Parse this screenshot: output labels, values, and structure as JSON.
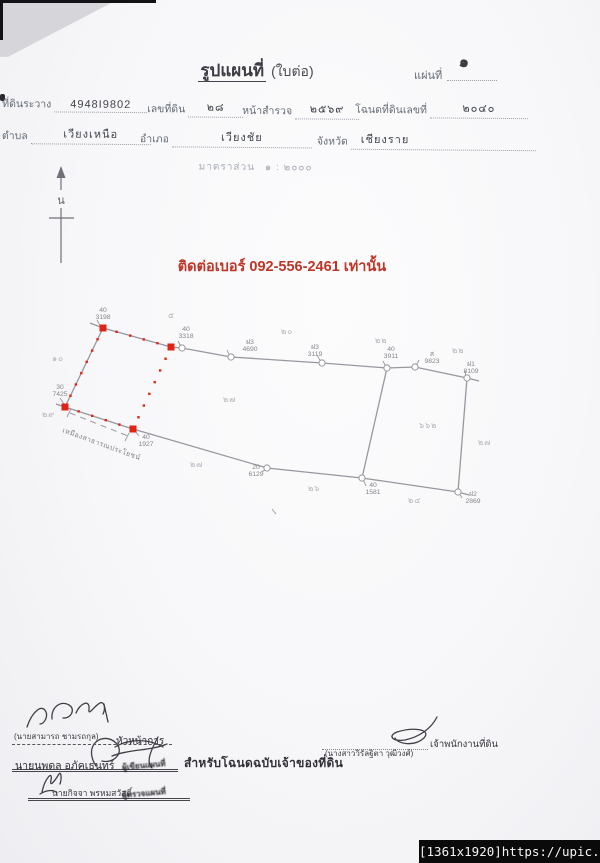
{
  "meta": {
    "watermark": "[1361x1920]https://upic.me/"
  },
  "header": {
    "title": "รูปแผนที่",
    "title_suffix": "(ใบต่อ)",
    "sheet_label": "แผ่นที่",
    "sheet_value": "๑"
  },
  "form": {
    "fields_row1": [
      {
        "label": "ที่ดินระวาง",
        "value": "4948I9802"
      },
      {
        "label": "เลขที่ดิน",
        "value": "๒๘"
      },
      {
        "label": "หน้าสำรวจ",
        "value": "๒๕๖๙"
      },
      {
        "label": "โฉนดที่ดินเลขที่",
        "value": "๒๐๔๐"
      }
    ],
    "fields_row2": [
      {
        "label": "ตำบล",
        "value": "เวียงเหนือ"
      },
      {
        "label": "อำเภอ",
        "value": "เวียงชัย"
      },
      {
        "label": "จังหวัด",
        "value": "เชียงราย"
      }
    ],
    "scale_label": "มาตราส่วน",
    "scale_value": "๑ : ๒๐๐๐"
  },
  "north_label": "น",
  "notice": {
    "text": "ติดต่อเบอร์ 092-556-2461 เท่านั้น",
    "color": "#bf3527"
  },
  "map": {
    "line_color": "#97979f",
    "red_color": "#df2417",
    "label_color": "#84848c",
    "adjacent_color": "#b2b2ba",
    "boundaries": [
      [
        [
          90,
          323
        ],
        [
          103,
          328
        ],
        [
          171,
          347
        ],
        [
          182,
          348
        ],
        [
          231,
          357
        ],
        [
          322,
          363
        ],
        [
          387,
          368
        ],
        [
          415,
          367
        ],
        [
          467,
          378
        ],
        [
          479,
          381
        ]
      ],
      [
        [
          103,
          328
        ],
        [
          65,
          407
        ]
      ],
      [
        [
          56,
          404
        ],
        [
          65,
          407
        ],
        [
          133,
          429
        ],
        [
          267,
          468
        ],
        [
          362,
          478
        ],
        [
          458,
          492
        ],
        [
          469,
          495
        ]
      ],
      [
        [
          467,
          378
        ],
        [
          458,
          492
        ]
      ],
      [
        [
          387,
          368
        ],
        [
          362,
          478
        ]
      ]
    ],
    "red_quad": [
      [
        103,
        328
      ],
      [
        171,
        347
      ],
      [
        133,
        429
      ],
      [
        65,
        407
      ]
    ],
    "circle_markers": [
      [
        182,
        348
      ],
      [
        231,
        357
      ],
      [
        322,
        363
      ],
      [
        387,
        368
      ],
      [
        415,
        367
      ],
      [
        467,
        378
      ],
      [
        267,
        468
      ],
      [
        362,
        478
      ],
      [
        458,
        492
      ]
    ],
    "ticks": [
      [
        [
          97,
          320
        ],
        [
          101,
          327
        ]
      ],
      [
        [
          178,
          341
        ],
        [
          181,
          347
        ]
      ],
      [
        [
          227,
          350
        ],
        [
          230,
          357
        ]
      ],
      [
        [
          317,
          355
        ],
        [
          321,
          362
        ]
      ],
      [
        [
          383,
          361
        ],
        [
          386,
          367
        ]
      ],
      [
        [
          419,
          360
        ],
        [
          416,
          366
        ]
      ],
      [
        [
          465,
          371
        ],
        [
          466,
          377
        ]
      ],
      [
        [
          60,
          398
        ],
        [
          64,
          404
        ]
      ],
      [
        [
          71,
          409
        ],
        [
          67,
          417
        ]
      ],
      [
        [
          139,
          436
        ],
        [
          135,
          431
        ]
      ],
      [
        [
          129,
          433
        ],
        [
          125,
          441
        ]
      ],
      [
        [
          262,
          472
        ],
        [
          266,
          469
        ]
      ],
      [
        [
          366,
          486
        ],
        [
          363,
          479
        ]
      ],
      [
        [
          462,
          498
        ],
        [
          459,
          493
        ]
      ],
      [
        [
          272,
          509
        ],
        [
          276,
          514
        ]
      ]
    ],
    "ditch_dash": [
      [
        70,
        413
      ],
      [
        128,
        436
      ]
    ],
    "ditch_label": {
      "text": "เหมืองสาธารณประโยชน์",
      "x": 62,
      "y": 432,
      "rotate": 20
    },
    "marker_labels": [
      {
        "code": "40",
        "num": "3198",
        "x": 103,
        "y": 312
      },
      {
        "code": "40",
        "num": "3318",
        "x": 186,
        "y": 331
      },
      {
        "code": "ฝ3",
        "num": "4690",
        "x": 250,
        "y": 344
      },
      {
        "code": "ฝ3",
        "num": "3119",
        "x": 315,
        "y": 349
      },
      {
        "code": "40",
        "num": "3911",
        "x": 391,
        "y": 351
      },
      {
        "code": "ส",
        "num": "9823",
        "x": 432,
        "y": 356
      },
      {
        "code": "ฝ1",
        "num": "8109",
        "x": 471,
        "y": 366
      },
      {
        "code": "30",
        "num": "7425",
        "x": 60,
        "y": 389
      },
      {
        "code": "40",
        "num": "1927",
        "x": 146,
        "y": 439
      },
      {
        "code": "20",
        "num": "6129",
        "x": 256,
        "y": 469
      },
      {
        "code": "40",
        "num": "1581",
        "x": 373,
        "y": 487
      },
      {
        "code": "ฝ2",
        "num": "2869",
        "x": 473,
        "y": 496
      }
    ],
    "adjacent_numbers": [
      {
        "text": "๑๐",
        "x": 52,
        "y": 361
      },
      {
        "text": "๕",
        "x": 168,
        "y": 318
      },
      {
        "text": "๒๐",
        "x": 281,
        "y": 334
      },
      {
        "text": "๒๒",
        "x": 375,
        "y": 343
      },
      {
        "text": "๒๒",
        "x": 452,
        "y": 353
      },
      {
        "text": "๒๙",
        "x": 42,
        "y": 417
      },
      {
        "text": "๒๗",
        "x": 223,
        "y": 402
      },
      {
        "text": "๖๖๒",
        "x": 419,
        "y": 428
      },
      {
        "text": "๒๗",
        "x": 478,
        "y": 445
      },
      {
        "text": "๒๗",
        "x": 190,
        "y": 467
      },
      {
        "text": "๒๖",
        "x": 308,
        "y": 491
      },
      {
        "text": "๒๔",
        "x": 408,
        "y": 503
      }
    ]
  },
  "footer": {
    "for_owner_text": "สำหรับโฉนดฉบับเจ้าของที่ดิน",
    "left_signers": [
      {
        "name": "(นายสามารถ ชามรถกุล)",
        "title": "หัวหน้าการ"
      },
      {
        "name": "นายนพดล อภัคเธนทร์",
        "title": "ผู้เขียนแผนที่"
      },
      {
        "name": "นายกิจจา พรหมสวัสดิ์",
        "title": "ผู้ตรวจแผนที่"
      }
    ],
    "right_signer": {
      "name": "(นางสาววิรัลฐิตา วุฒิวงศ์)",
      "title": "เจ้าพนักงานที่ดิน"
    }
  }
}
